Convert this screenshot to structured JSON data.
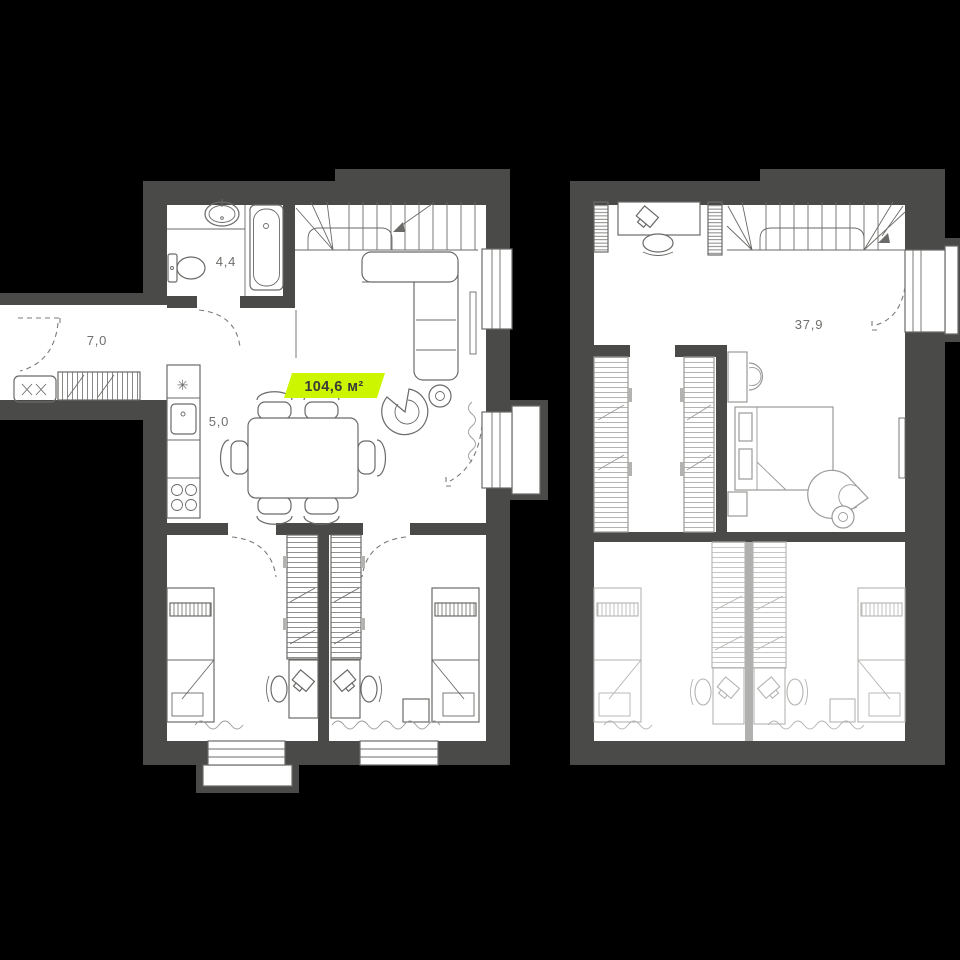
{
  "app": {
    "title": "duplex-floor-plans"
  },
  "colors": {
    "background": "#000000",
    "wall": "#4a4a48",
    "floor": "#ffffff",
    "furniture_floor1": "#6a6a68",
    "furniture_floor2_mid": "#9a9a98",
    "furniture_floor2_light": "#b3b3b1",
    "light_partition": "#b0b0ae",
    "accent": "#ccf500",
    "accent_text": "#3a3a38",
    "label_text": "#6e6e6c"
  },
  "floor1": {
    "name": "first-floor-plan",
    "area_badge": "104,6 м²",
    "room_labels": [
      {
        "id": "bathroom",
        "text": "4,4"
      },
      {
        "id": "hallway",
        "text": "7,0"
      },
      {
        "id": "kitchen",
        "text": "5,0"
      }
    ],
    "icons": {
      "freezer": "✳"
    }
  },
  "floor2": {
    "name": "second-floor-plan",
    "room_labels": [
      {
        "id": "hall",
        "text": "37,9"
      }
    ]
  }
}
